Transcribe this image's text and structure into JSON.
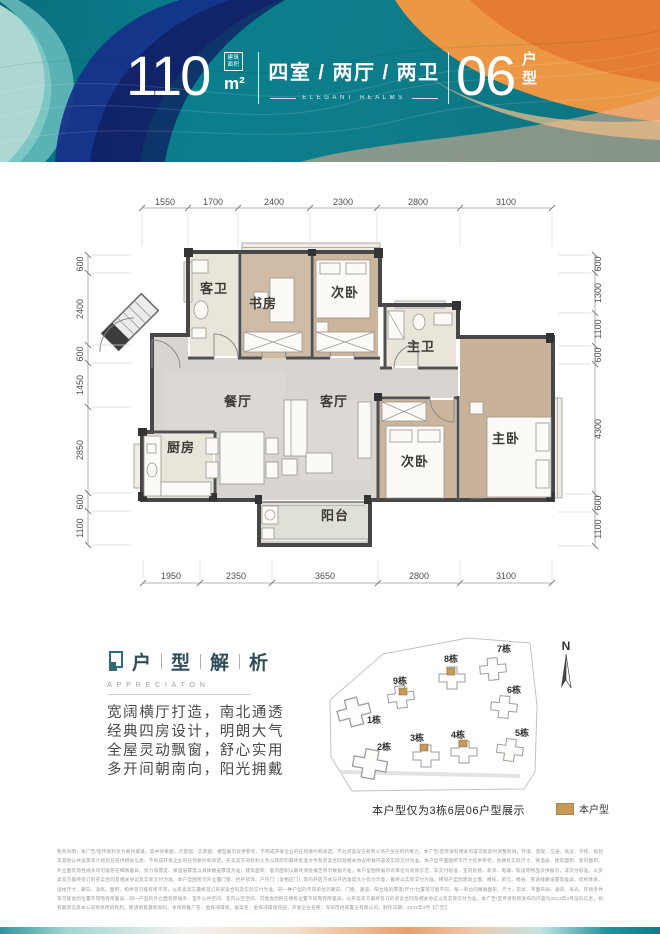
{
  "header": {
    "area_value": "110",
    "area_unit_box": [
      "建筑",
      "面积"
    ],
    "area_unit": "m²",
    "layout_text": "四室 / 两厅 / 两卫",
    "layout_subtitle": "ELEGANT REALMS",
    "unit_value": "06",
    "unit_suffix": [
      "户",
      "型"
    ]
  },
  "floorplan": {
    "rooms": {
      "guest_bath": "客卫",
      "study": "书房",
      "bedroom_top": "次卧",
      "master_bath": "主卫",
      "dining": "餐厅",
      "living": "客厅",
      "kitchen": "厨房",
      "bedroom_bottom": "次卧",
      "master": "主卧",
      "balcony": "阳台"
    },
    "dims_top": [
      "1550",
      "1700",
      "2400",
      "2300",
      "2800",
      "3100"
    ],
    "dims_bottom": [
      "1950",
      "2350",
      "3650",
      "2800",
      "3100"
    ],
    "dims_left": [
      "600",
      "2400",
      "600",
      "1450",
      "2850",
      "600",
      "1100"
    ],
    "dims_right": [
      "600",
      "1300",
      "1100",
      "600",
      "4300",
      "600",
      "1100"
    ]
  },
  "analysis": {
    "title_chars": [
      "户",
      "型",
      "解",
      "析"
    ],
    "subtitle": "APPRECIATON",
    "lines": [
      "宽阔横厅打造，南北通透",
      "经典四房设计，明朗大气",
      "全屋灵动飘窗，舒心实用",
      "多开间朝南向，阳光拥戴"
    ]
  },
  "sitemap": {
    "buildings": [
      {
        "label": "1栋"
      },
      {
        "label": "2栋"
      },
      {
        "label": "3栋"
      },
      {
        "label": "4栋"
      },
      {
        "label": "5栋"
      },
      {
        "label": "6栋"
      },
      {
        "label": "7栋"
      },
      {
        "label": "8栋"
      },
      {
        "label": "9栋"
      }
    ],
    "compass": "N",
    "caption": "本户型仅为3栋6层06户型展示",
    "legend_label": "本户型",
    "highlight_color": "#c49a5a"
  },
  "disclaimer": "免责声明：本广告/宣传资料仅为要约邀请，其中效果图、示意图、实景图、模型展示仅供参考，不构成开发企业的任何要约和承诺，不对买卖双方权利义务产生任何约束力。本广告/宣传资料相关内容可能适时调整改进，环境、景观、交通、商业、学校、规划及其他公共设施等介绍旨在提供相关信息，不构成开发企业的任何要约和承诺，买卖双方的权利义务以政府的最终批准文件及买卖合同及相关协议所载内容及实际交付为准。本户型平面图所示尺寸仅供参考，各楼栋实际尺寸、保温层、建筑面积、套内面积、外立面装饰性线条均可能存在细微差异，剪力墙厚度、保温层厚度以具体楼层厚度为准，建筑面积、套内面积以最终测绘报告所示数据为准。本户型图所展示的单位为装修示范，非交付标准，室内装修、家具、电器、陈设等物品仅供展示，非交付标准，以买卖双方最终签订的买卖合同及相关协议及实际交付为准。本户型图所示外立面门窗、栏杆装饰、户内门（含相应门）等的开启方式与开启角度大小仅为示意，最终以实际交付为准。相同户型因建筑立面、楼栋、单元、楼层、管道线路设置等差异，结构体系、墙柱尺寸、朝向、净高、面积、构件等可能有所不同，以买卖双方最终签订的买卖合同及实际交付为准。同一种户型的不同单位的朝向、门窗、通道、阳台墙的厚度/尺寸/位置等可能不同，每一单位的精确图形、尺寸、形状、平面布局、通风、采光、环境条件等可能会因位置不同而有所差异。同一户型的外立面装饰线条、室外公共空间、室内公区空间，可能会因所在楼栋位置不同而有所差异，以买卖双方最终签订的买卖合同及相关协议以及实际交付为准。本广告/宣传资料所发布的内容为2023年3月前的信息，如有最新信息本公司有修改的权利，敬请留意最新资料。本项目推广名：金辉湾璟境，备案名：金辉湾璟境花园，开发企业名称：深圳市招商置业有限公司，制作日期：2023年3月【广告】"
}
